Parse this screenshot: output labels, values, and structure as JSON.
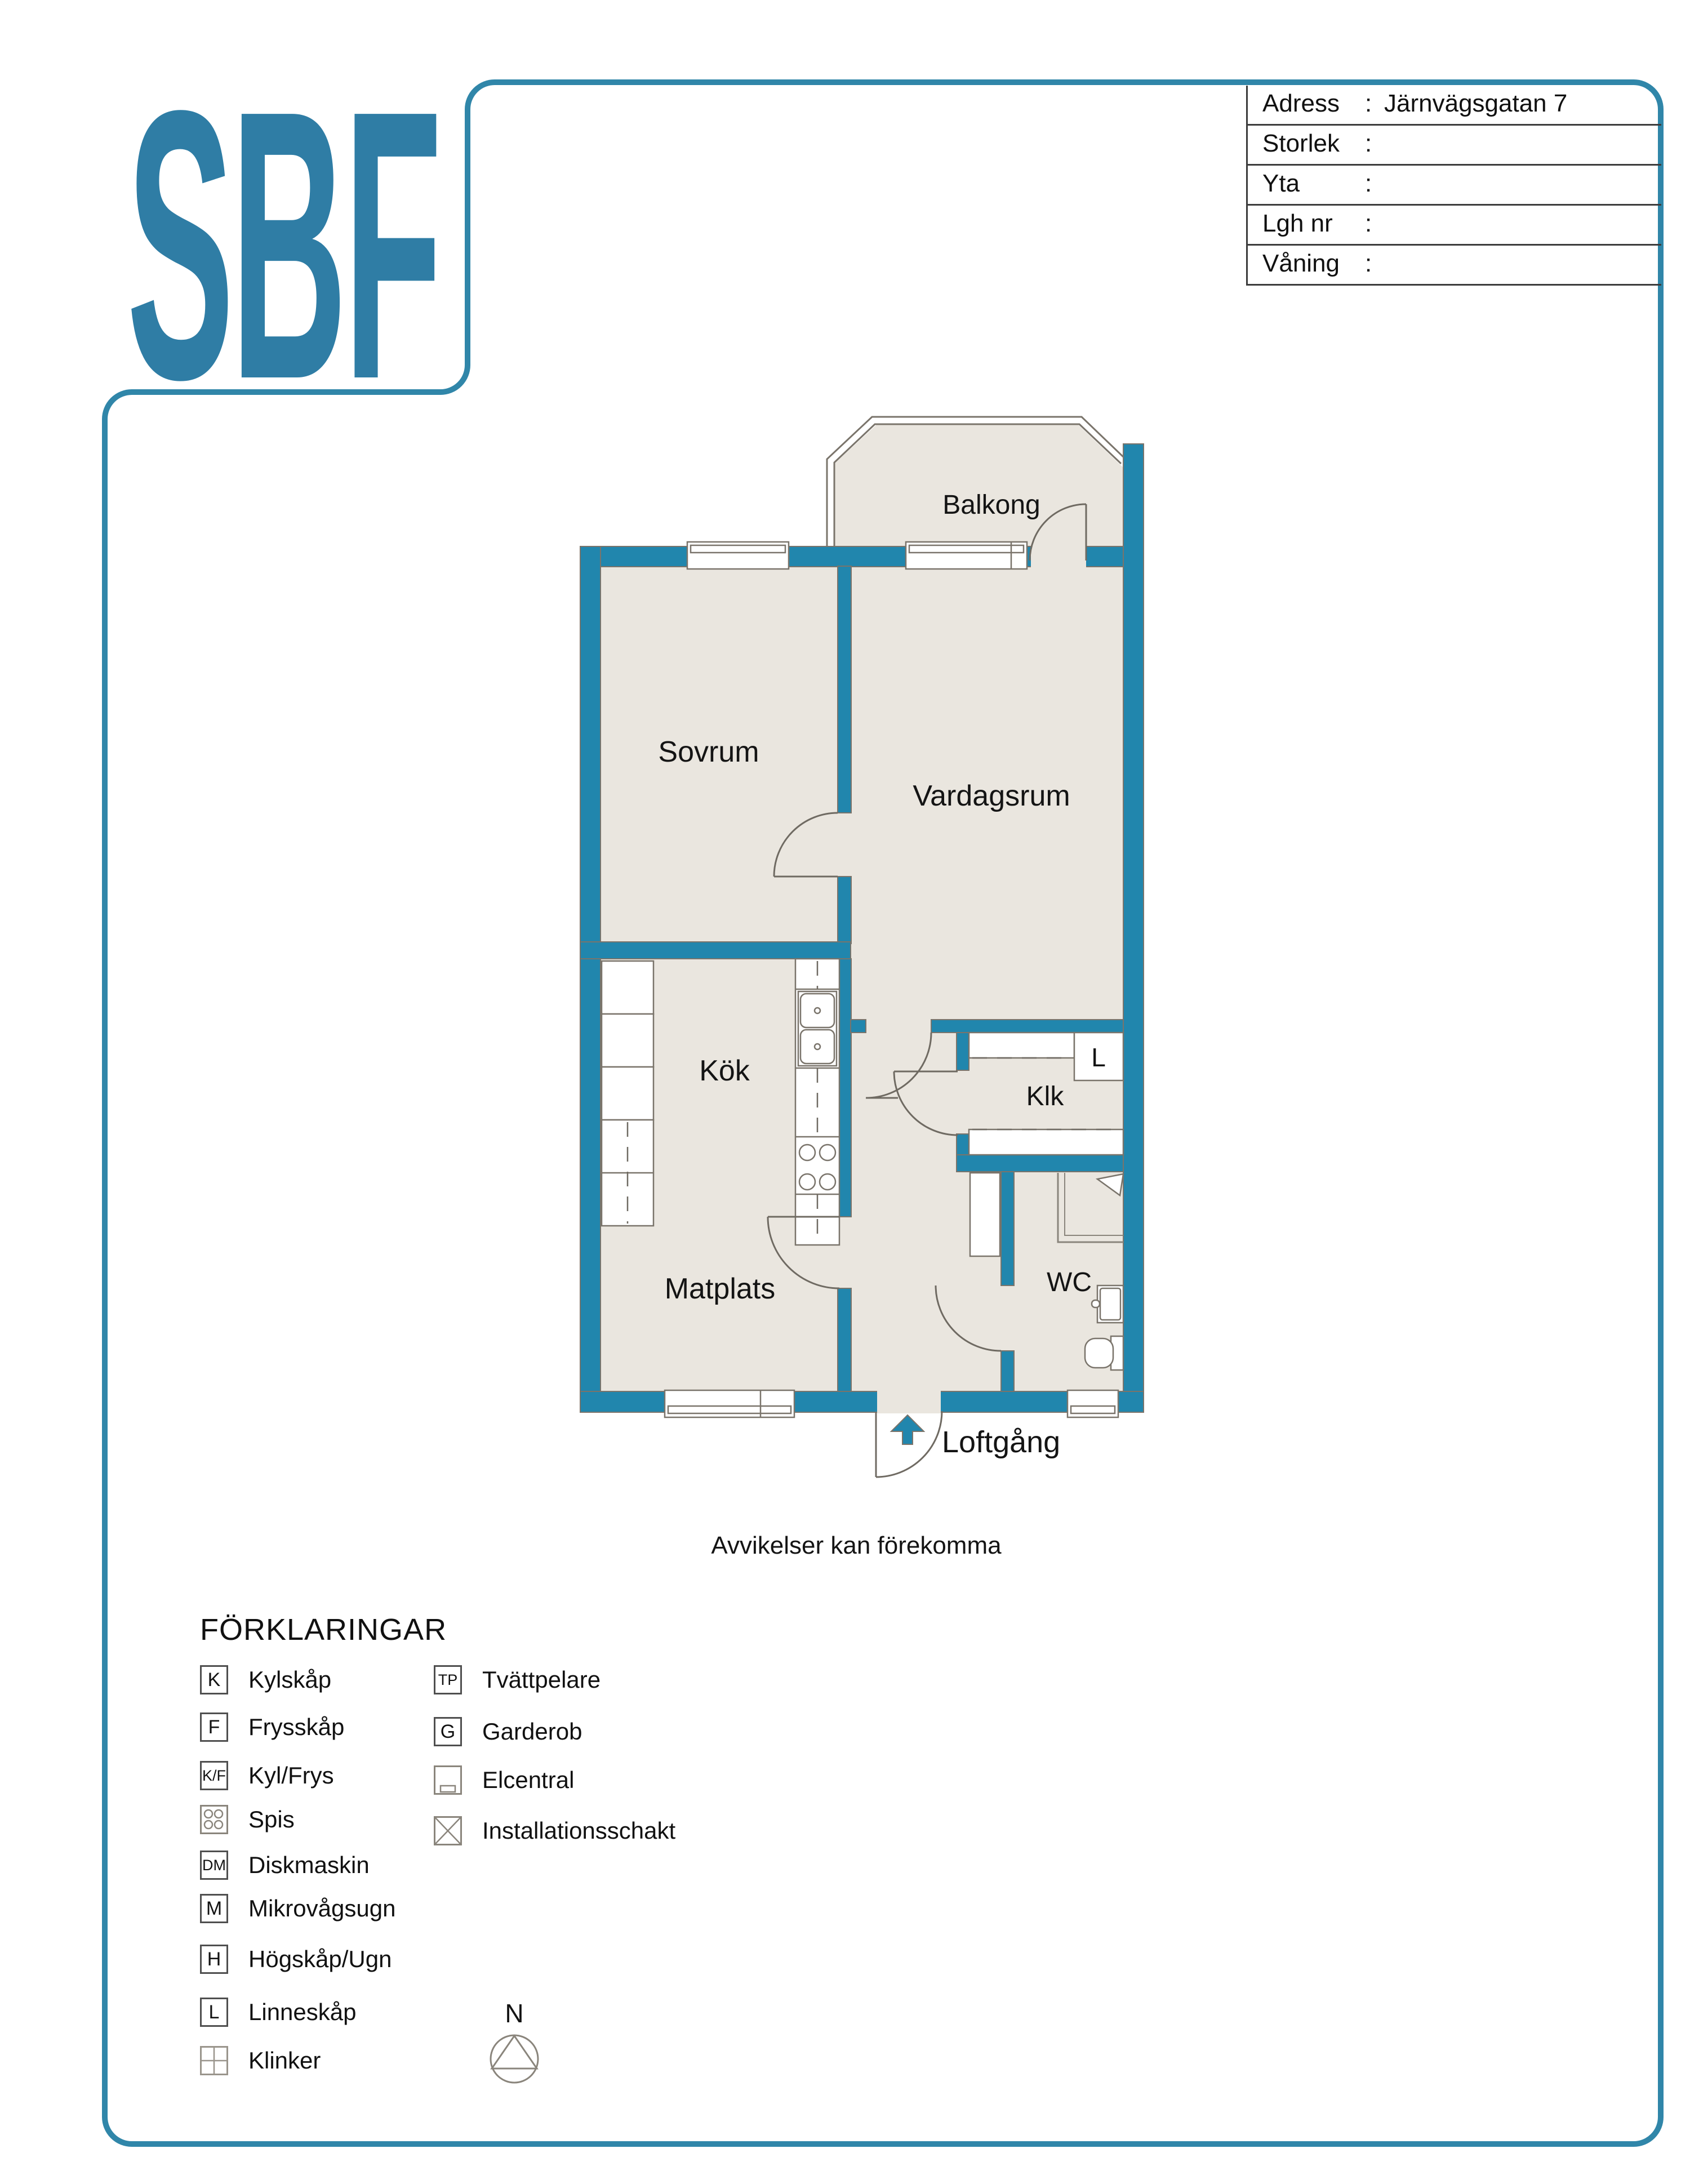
{
  "logo": {
    "text": "SBF"
  },
  "info_table": {
    "rows": [
      {
        "label": "Adress",
        "sep": ":",
        "value": "Järnvägsgatan 7"
      },
      {
        "label": "Storlek",
        "sep": ":",
        "value": ""
      },
      {
        "label": "Yta",
        "sep": ":",
        "value": ""
      },
      {
        "label": "Lgh nr",
        "sep": ":",
        "value": ""
      },
      {
        "label": "Våning",
        "sep": ":",
        "value": ""
      }
    ]
  },
  "floorplan": {
    "rooms": {
      "balcony": "Balkong",
      "bedroom": "Sovrum",
      "living": "Vardagsrum",
      "kitchen": "Kök",
      "closet": "Klk",
      "linen_cabinet": "L",
      "wc": "WC",
      "dining": "Matplats",
      "walkway": "Loftgång"
    },
    "disclaimer": "Avvikelser kan förekomma",
    "colors": {
      "wall": "#2186ad",
      "floor": "#eae6df",
      "outline": "#7a746b",
      "border": "#3086a9"
    }
  },
  "legend": {
    "title": "FÖRKLARINGAR",
    "left": [
      {
        "symbol": "K",
        "label": "Kylskåp"
      },
      {
        "symbol": "F",
        "label": "Frysskåp"
      },
      {
        "symbol": "K/F",
        "label": "Kyl/Frys"
      },
      {
        "symbol": "",
        "label": "Spis"
      },
      {
        "symbol": "DM",
        "label": "Diskmaskin"
      },
      {
        "symbol": "M",
        "label": "Mikrovågsugn"
      },
      {
        "symbol": "H",
        "label": "Högskåp/Ugn"
      },
      {
        "symbol": "L",
        "label": "Linneskåp"
      },
      {
        "symbol": "",
        "label": "Klinker"
      }
    ],
    "right": [
      {
        "symbol": "TP",
        "label": "Tvättpelare"
      },
      {
        "symbol": "G",
        "label": "Garderob"
      },
      {
        "symbol": "",
        "label": "Elcentral"
      },
      {
        "symbol": "",
        "label": "Installationsschakt"
      }
    ]
  },
  "compass": {
    "label": "N"
  }
}
